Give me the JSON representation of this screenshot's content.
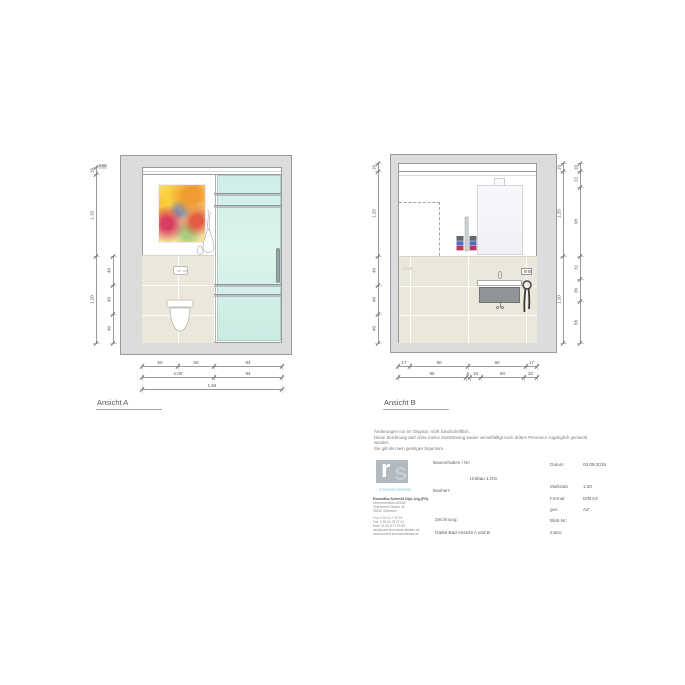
{
  "sheet": {
    "view_a": {
      "label": "Ansicht A",
      "dims": {
        "height_note": "2.50",
        "left_outer": [
          "10",
          "1.18",
          "1.20"
        ],
        "left_rows": [
          "40",
          "40",
          "40"
        ],
        "bottom_r1": [
          "50",
          "50",
          "94"
        ],
        "bottom_r2": [
          "1.00",
          "94"
        ],
        "bottom_r3": [
          "1.94"
        ]
      }
    },
    "view_b": {
      "label": "Ansicht B",
      "dims": {
        "left": [
          "10",
          "1.20",
          "40",
          "40",
          "40"
        ],
        "right_inner": [
          "10",
          "1.20",
          "1.20"
        ],
        "right_outer": [
          "10",
          "22",
          "98",
          "32",
          "30",
          "58"
        ],
        "bottom_r1": [
          "17",
          "80",
          "80",
          "17"
        ],
        "bottom_r2": [
          "95",
          "5",
          "15",
          "60",
          "20"
        ]
      }
    }
  },
  "notice_lines": [
    "Änderungen nur im Original, nicht handschriftlich.",
    "Diese Zeichnung darf ohne meine Zustimmung weder vervielfältigt noch dritten Personen zugänglich gemacht",
    "werden.",
    "Sie gilt als mein geistiges Eigentum."
  ],
  "logo": {
    "letter_r": "r",
    "letter_s": "s",
    "subtitle": "innenarchitektur"
  },
  "address": {
    "name": "Roswitha Schmitt Dipl.-Ing.(FH)",
    "lines": [
      "Innenarchitektin AKBW",
      "Gütersloher Straße 45",
      "33330 Gütersloh"
    ],
    "contact": [
      "Fon:  0 52 41 7 49 18",
      "Fax:  0 52 41 78 37 91",
      "Mob: 01 60 8 77 09 99",
      "info@schmitt-innenarchitektur.de",
      "www.schmitt-innenarchitektur.de"
    ]
  },
  "title_block": {
    "bauvorhaben_label": "Bauvorhaben / Nr:",
    "bauvorhaben_value": "Umbau 1.OG",
    "bauherr_label": "Bauherr:",
    "zeichnung_label": "Zeichnung:",
    "zeichnung_value": "Gäste Bad Ansicht A und B",
    "fields": [
      {
        "label": "Datum",
        "value": "03.09.2015"
      },
      {
        "label": "Maßstab",
        "value": "1:20"
      },
      {
        "label": "Format",
        "value": "DIN A3"
      },
      {
        "label": "gez.",
        "value": "AZ"
      },
      {
        "label": "Blatt-Nr:",
        "value": ""
      },
      {
        "label": "Index:",
        "value": ""
      }
    ]
  },
  "colors": {
    "glass_green": "#cdeee6",
    "tile_beige": "#ece7db",
    "wall_gray": "#dcdcdc",
    "logo_blue": "#8fc8dd",
    "towel_blue": "#4a70c4",
    "towel_red": "#b43a63"
  }
}
